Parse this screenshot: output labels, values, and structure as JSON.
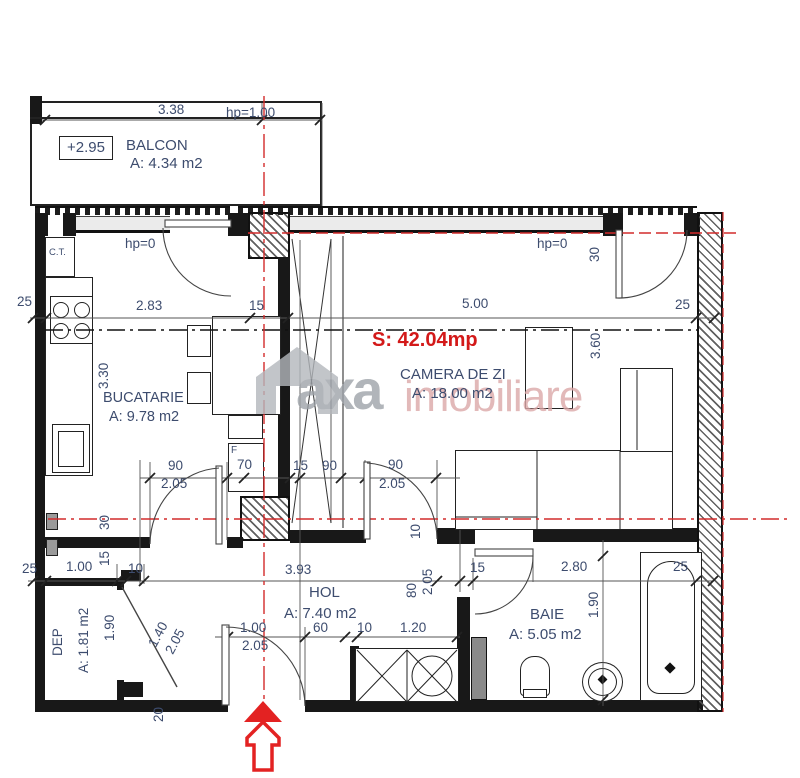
{
  "plan": {
    "total_area_label": "S: 42.04mp",
    "accent_red": "#d31919",
    "dim_text_color": "#3d4c6e"
  },
  "rooms": {
    "balcon": {
      "level": "+2.95",
      "name": "BALCON",
      "area": "A: 4.34 m2"
    },
    "bucatarie": {
      "name": "BUCATARIE",
      "area": "A: 9.78 m2"
    },
    "camera_de_zi": {
      "name": "CAMERA DE ZI",
      "area": "A: 18.00 m2",
      "total": "S: 42.04mp"
    },
    "hol": {
      "name": "HOL",
      "area": "A: 7.40 m2"
    },
    "baie": {
      "name": "BAIE",
      "area": "A: 5.05 m2"
    },
    "dep": {
      "name": "DEP",
      "area": "A: 1.81 m2"
    },
    "ct": {
      "name": "C.T."
    }
  },
  "watermark": {
    "brand_left": "axa",
    "brand_right": "imobiliare"
  },
  "dimensions": [
    {
      "t": "3.38",
      "x": 158,
      "y": 103
    },
    {
      "t": "hp=1.00",
      "x": 226,
      "y": 106
    },
    {
      "t": "hp=0",
      "x": 125,
      "y": 237
    },
    {
      "t": "hp=0",
      "x": 537,
      "y": 237
    },
    {
      "t": "25",
      "x": 17,
      "y": 295
    },
    {
      "t": "2.83",
      "x": 136,
      "y": 299
    },
    {
      "t": "15",
      "x": 249,
      "y": 299
    },
    {
      "t": "5.00",
      "x": 462,
      "y": 297
    },
    {
      "t": "25",
      "x": 675,
      "y": 298
    },
    {
      "t": "30",
      "x": 588,
      "y": 262,
      "r": -90
    },
    {
      "t": "3.30",
      "x": 97,
      "y": 389,
      "r": -90
    },
    {
      "t": "3.60",
      "x": 589,
      "y": 359,
      "r": -90
    },
    {
      "t": "90",
      "x": 168,
      "y": 459
    },
    {
      "t": "2.05",
      "x": 161,
      "y": 477
    },
    {
      "t": "F",
      "x": 231,
      "y": 446,
      "fs": 10
    },
    {
      "t": "70",
      "x": 237,
      "y": 458
    },
    {
      "t": "15",
      "x": 293,
      "y": 459
    },
    {
      "t": "90",
      "x": 322,
      "y": 459
    },
    {
      "t": "90",
      "x": 388,
      "y": 458
    },
    {
      "t": "2.05",
      "x": 379,
      "y": 477
    },
    {
      "t": "10",
      "x": 409,
      "y": 539,
      "r": -90
    },
    {
      "t": "30",
      "x": 98,
      "y": 530,
      "r": -90
    },
    {
      "t": "15",
      "x": 98,
      "y": 566,
      "r": -90
    },
    {
      "t": "25",
      "x": 22,
      "y": 562
    },
    {
      "t": "1.00",
      "x": 66,
      "y": 560
    },
    {
      "t": "10",
      "x": 128,
      "y": 562
    },
    {
      "t": "3.93",
      "x": 285,
      "y": 563
    },
    {
      "t": "80",
      "x": 405,
      "y": 598,
      "r": -90
    },
    {
      "t": "2.05",
      "x": 421,
      "y": 595,
      "r": -90
    },
    {
      "t": "15",
      "x": 470,
      "y": 561
    },
    {
      "t": "2.80",
      "x": 561,
      "y": 560
    },
    {
      "t": "25",
      "x": 673,
      "y": 560
    },
    {
      "t": "1.90",
      "x": 103,
      "y": 641,
      "r": -90
    },
    {
      "t": "1.40",
      "x": 146,
      "y": 643,
      "r": -62
    },
    {
      "t": "2.05",
      "x": 163,
      "y": 650,
      "r": -62
    },
    {
      "t": "20",
      "x": 152,
      "y": 722,
      "r": -90
    },
    {
      "t": "1.90",
      "x": 587,
      "y": 618,
      "r": -90
    },
    {
      "t": "1.00",
      "x": 240,
      "y": 621
    },
    {
      "t": "2.05",
      "x": 242,
      "y": 639
    },
    {
      "t": "60",
      "x": 313,
      "y": 621
    },
    {
      "t": "10",
      "x": 357,
      "y": 621
    },
    {
      "t": "1.20",
      "x": 400,
      "y": 621
    }
  ]
}
